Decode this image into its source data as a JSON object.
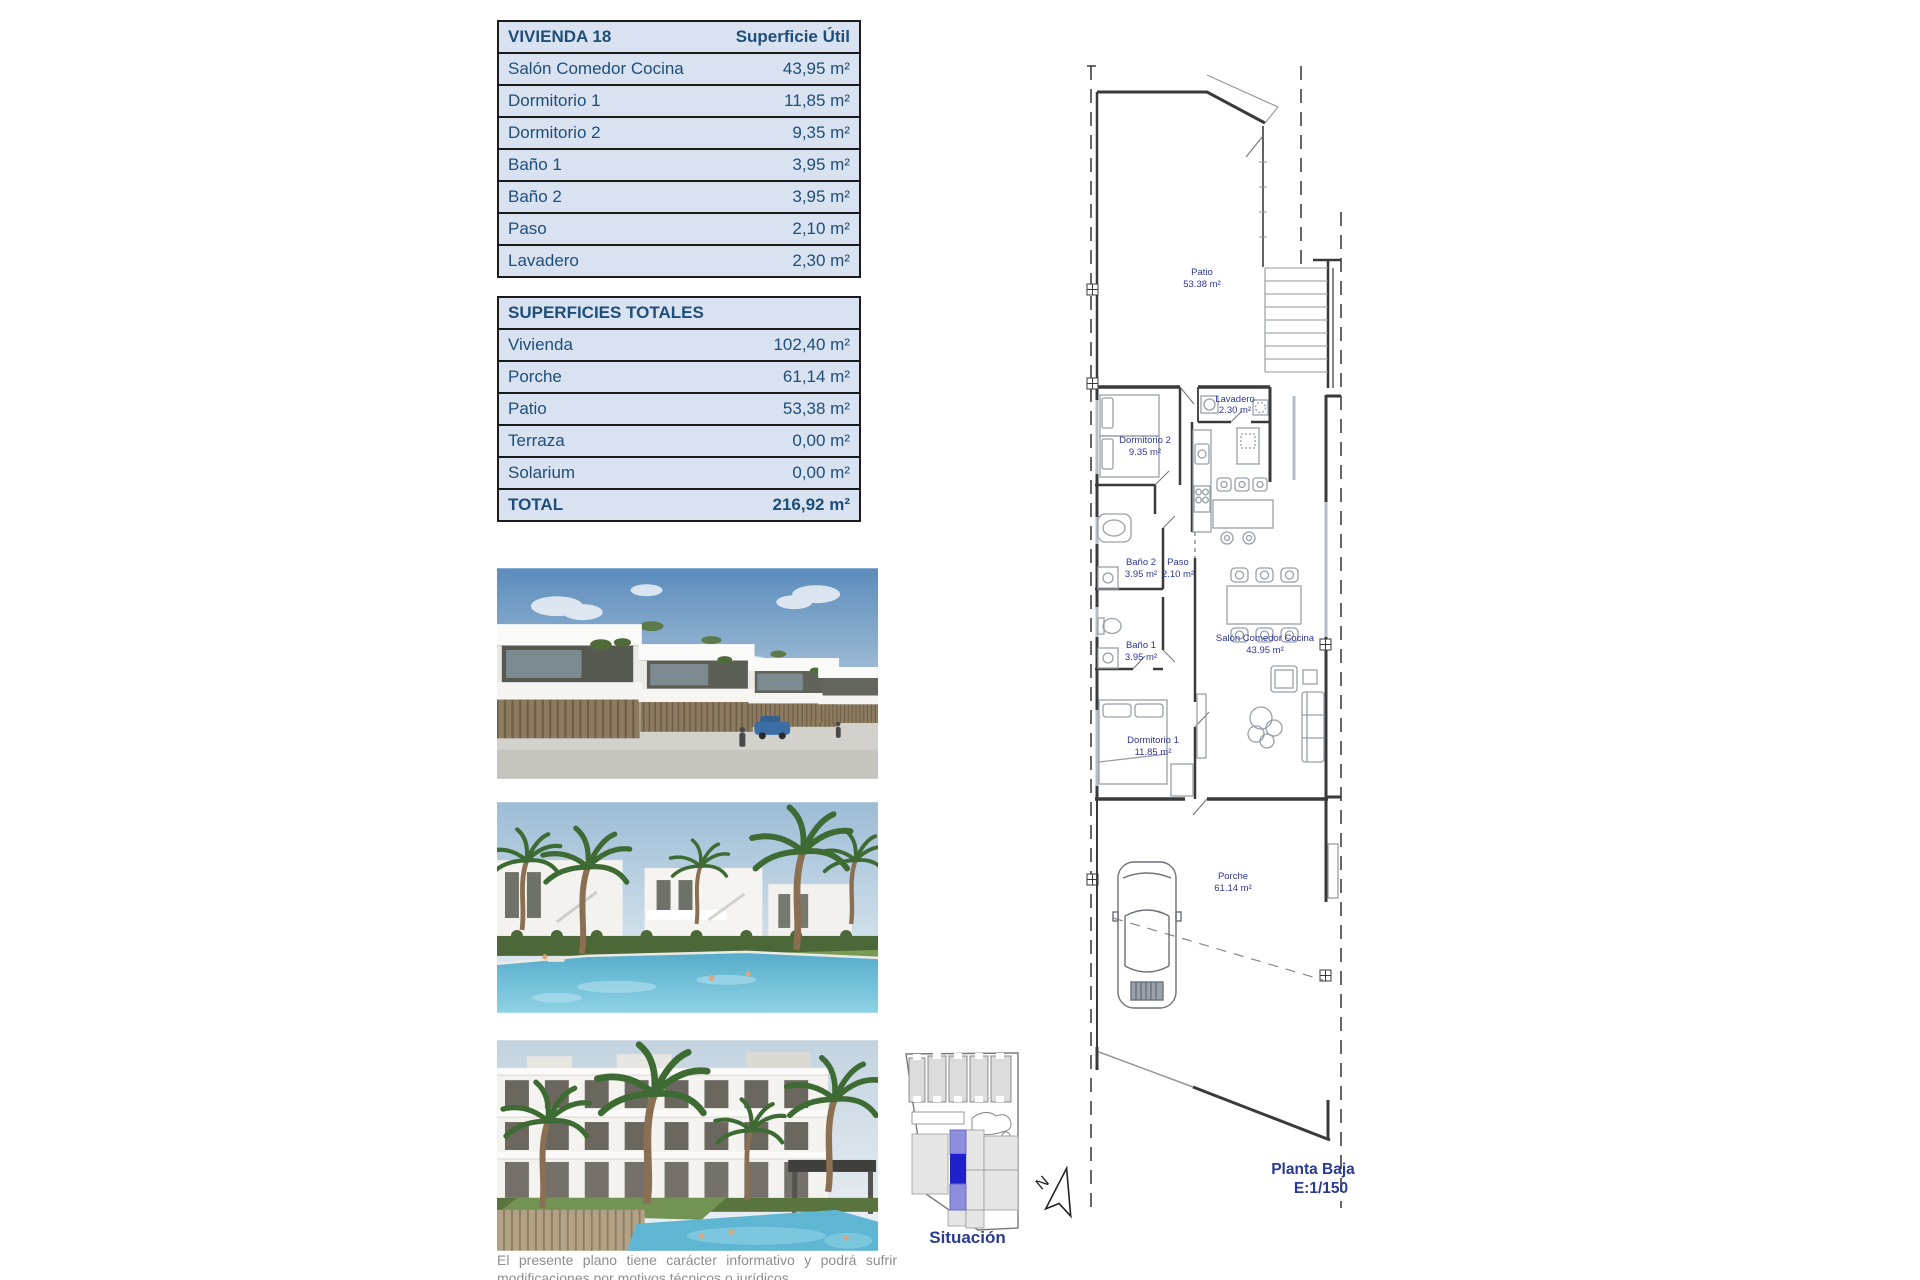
{
  "vivienda_table": {
    "title": "VIVIENDA 18",
    "column_header": "Superficie Útil",
    "rows": [
      {
        "label": "Salón Comedor Cocina",
        "value": "43,95 m²"
      },
      {
        "label": "Dormitorio 1",
        "value": "11,85 m²"
      },
      {
        "label": "Dormitorio 2",
        "value": "9,35 m²"
      },
      {
        "label": "Baño 1",
        "value": "3,95 m²"
      },
      {
        "label": "Baño 2",
        "value": "3,95 m²"
      },
      {
        "label": "Paso",
        "value": "2,10 m²"
      },
      {
        "label": "Lavadero",
        "value": "2,30 m²"
      }
    ]
  },
  "totales_table": {
    "title": "SUPERFICIES TOTALES",
    "rows": [
      {
        "label": "Vivienda",
        "value": "102,40 m²"
      },
      {
        "label": "Porche",
        "value": "61,14 m²"
      },
      {
        "label": "Patio",
        "value": "53,38 m²"
      },
      {
        "label": "Terraza",
        "value": "0,00 m²"
      },
      {
        "label": "Solarium",
        "value": "0,00 m²"
      }
    ],
    "total_row": {
      "label": "TOTAL",
      "value": "216,92 m²"
    }
  },
  "floor_plan": {
    "rooms": {
      "patio": {
        "name": "Patio",
        "area": "53.38 m²"
      },
      "lavadero": {
        "name": "Lavadero",
        "area": "2.30 m²"
      },
      "dormitorio2": {
        "name": "Dormitorio 2",
        "area": "9.35 m²"
      },
      "bano2": {
        "name": "Baño 2",
        "area": "3.95 m²"
      },
      "paso": {
        "name": "Paso",
        "area": "2.10 m²"
      },
      "bano1": {
        "name": "Baño 1",
        "area": "3.95 m²"
      },
      "dormitorio1": {
        "name": "Dormitorio 1",
        "area": "11.85 m²"
      },
      "salon": {
        "name": "Salón Comedor Cocina",
        "area": "43.95 m²"
      },
      "porche": {
        "name": "Porche",
        "area": "61.14 m²"
      }
    },
    "caption": {
      "title": "Planta Baja",
      "scale": "E:1/150"
    },
    "north_label": "N"
  },
  "situacion": {
    "caption": "Situación"
  },
  "disclaimer": "El presente plano tiene carácter informativo y podrá sufrir modificaciones por motivos técnicos o jurídicos.",
  "colors": {
    "table_text": "#1F4E79",
    "table_background": "#D9E2F0",
    "table_border": "#1C1C1C",
    "plan_label": "#2F3796",
    "caption_navy": "#2B3A94",
    "highlight_blue": "#2020CC",
    "highlight_light": "#8E8EDE",
    "disclaimer_gray": "#8E8E8E"
  }
}
